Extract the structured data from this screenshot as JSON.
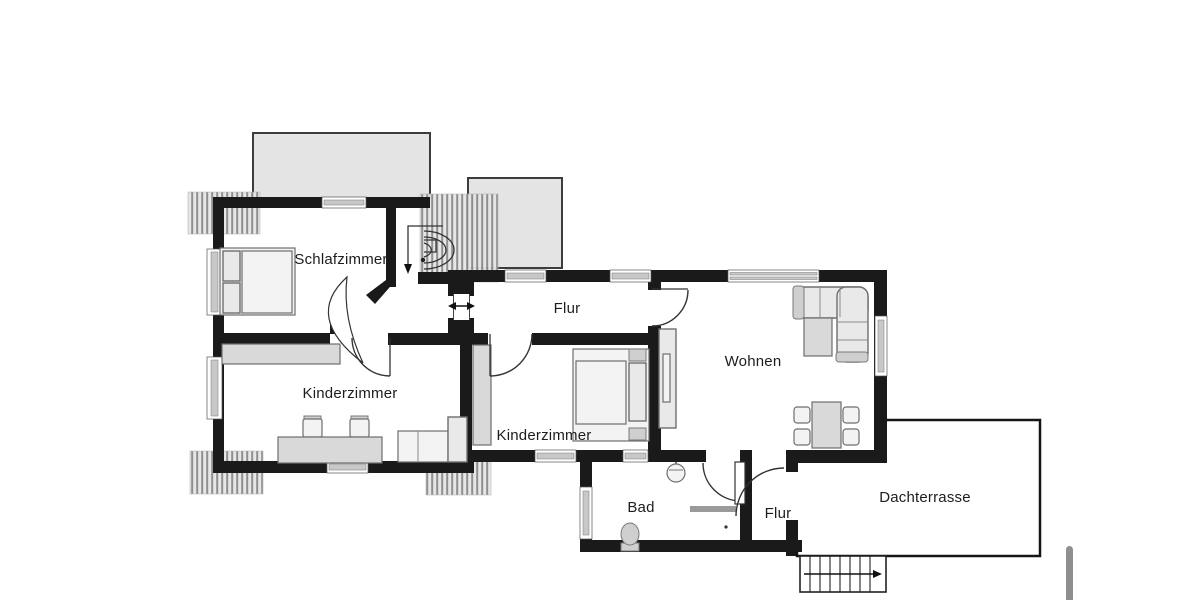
{
  "floorplan": {
    "rooms": {
      "schlafzimmer": {
        "label": "Schlafzimmer"
      },
      "flur_upper": {
        "label": "Flur"
      },
      "kinderzimmer_left": {
        "label": "Kinderzimmer"
      },
      "kinderzimmer_center": {
        "label": "Kinderzimmer"
      },
      "wohnen": {
        "label": "Wohnen"
      },
      "bad": {
        "label": "Bad"
      },
      "flur_lower": {
        "label": "Flur"
      },
      "dachterrasse": {
        "label": "Dachterrasse"
      }
    },
    "colors": {
      "wall": "#1a1a1a",
      "dormer-fill": "#e4e4e4",
      "furniture-fill": "#e9e9e9",
      "furniture-stroke": "#6e6e6e",
      "hatch-line": "#8a8a8a",
      "label-color": "#1d1d1d",
      "scrollbar": "#8f8f8f",
      "background": "#ffffff"
    }
  }
}
